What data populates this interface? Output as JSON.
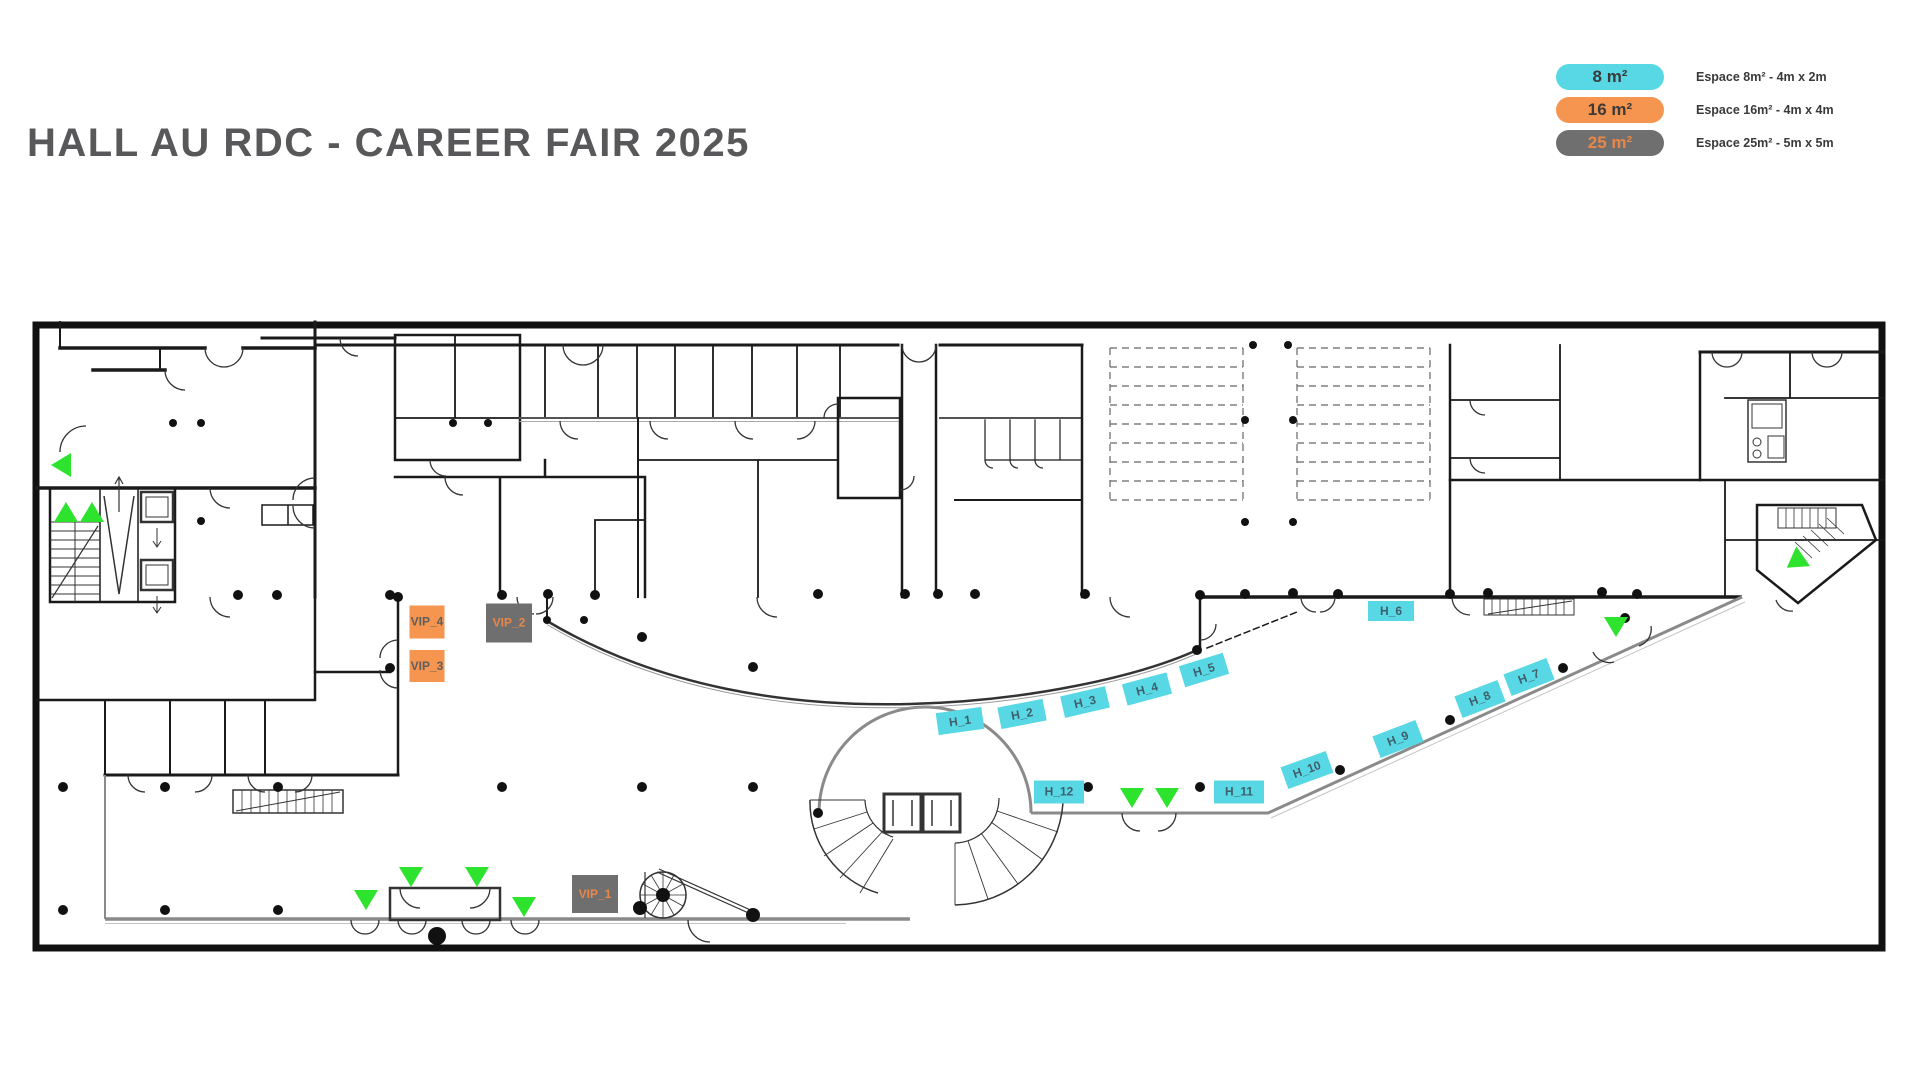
{
  "title": "HALL AU RDC - CAREER FAIR 2025",
  "legend": {
    "items": [
      {
        "label": "8 m²",
        "desc": "Espace 8m² - 4m x 2m",
        "color": "#58d8e4",
        "text_color": "#3a3a3a"
      },
      {
        "label": "16 m²",
        "desc": "Espace 16m² - 4m x 4m",
        "color": "#f6954f",
        "text_color": "#3a3a3a"
      },
      {
        "label": "25 m²",
        "desc": "Espace 25m² - 5m x 5m",
        "color": "#6f6f6f",
        "text_color": "#e8874a"
      }
    ]
  },
  "floorplan": {
    "colors": {
      "booth_8m2": "#58d8e4",
      "booth_16m2": "#f6954f",
      "booth_25m2": "#6f6f6f",
      "arrow_green": "#2ee32e",
      "wall": "#1a1a1a",
      "facade_gray": "#8a8a8a"
    },
    "booths": [
      {
        "id": "H_1",
        "label": "H_1",
        "size_m2": 8,
        "x": 960,
        "y": 721,
        "w": 46,
        "h": 22,
        "rot": -8
      },
      {
        "id": "H_2",
        "label": "H_2",
        "size_m2": 8,
        "x": 1022,
        "y": 714,
        "w": 46,
        "h": 22,
        "rot": -11
      },
      {
        "id": "H_3",
        "label": "H_3",
        "size_m2": 8,
        "x": 1085,
        "y": 702,
        "w": 46,
        "h": 22,
        "rot": -13
      },
      {
        "id": "H_4",
        "label": "H_4",
        "size_m2": 8,
        "x": 1147,
        "y": 689,
        "w": 46,
        "h": 22,
        "rot": -15
      },
      {
        "id": "H_5",
        "label": "H_5",
        "size_m2": 8,
        "x": 1204,
        "y": 670,
        "w": 46,
        "h": 22,
        "rot": -17
      },
      {
        "id": "H_6",
        "label": "H_6",
        "size_m2": 8,
        "x": 1391,
        "y": 611,
        "w": 46,
        "h": 20,
        "rot": 0
      },
      {
        "id": "H_7",
        "label": "H_7",
        "size_m2": 8,
        "x": 1529,
        "y": 677,
        "w": 46,
        "h": 23,
        "rot": -21
      },
      {
        "id": "H_8",
        "label": "H_8",
        "size_m2": 8,
        "x": 1480,
        "y": 699,
        "w": 46,
        "h": 23,
        "rot": -21
      },
      {
        "id": "H_9",
        "label": "H_9",
        "size_m2": 8,
        "x": 1398,
        "y": 739,
        "w": 46,
        "h": 23,
        "rot": -21
      },
      {
        "id": "H_10",
        "label": "H_10",
        "size_m2": 8,
        "x": 1307,
        "y": 770,
        "w": 48,
        "h": 23,
        "rot": -20
      },
      {
        "id": "H_11",
        "label": "H_11",
        "size_m2": 8,
        "x": 1239,
        "y": 792,
        "w": 50,
        "h": 23,
        "rot": 0
      },
      {
        "id": "H_12",
        "label": "H_12",
        "size_m2": 8,
        "x": 1059,
        "y": 792,
        "w": 50,
        "h": 23,
        "rot": 0
      },
      {
        "id": "VIP_1",
        "label": "VIP_1",
        "size_m2": 25,
        "x": 595,
        "y": 894,
        "w": 46,
        "h": 38,
        "rot": 0
      },
      {
        "id": "VIP_2",
        "label": "VIP_2",
        "size_m2": 25,
        "x": 509,
        "y": 623,
        "w": 46,
        "h": 39,
        "rot": 0
      },
      {
        "id": "VIP_3",
        "label": "VIP_3",
        "size_m2": 16,
        "x": 427,
        "y": 666,
        "w": 35,
        "h": 32,
        "rot": 0
      },
      {
        "id": "VIP_4",
        "label": "VIP_4",
        "size_m2": 16,
        "x": 427,
        "y": 622,
        "w": 35,
        "h": 33,
        "rot": 0
      }
    ],
    "arrows": [
      {
        "x": 61,
        "y": 465,
        "rot": -90
      },
      {
        "x": 66,
        "y": 512,
        "rot": 0
      },
      {
        "x": 92,
        "y": 512,
        "rot": 0
      },
      {
        "x": 366,
        "y": 900,
        "rot": 180
      },
      {
        "x": 411,
        "y": 877,
        "rot": 180
      },
      {
        "x": 477,
        "y": 877,
        "rot": 180
      },
      {
        "x": 524,
        "y": 907,
        "rot": 180
      },
      {
        "x": 1132,
        "y": 798,
        "rot": 180
      },
      {
        "x": 1167,
        "y": 798,
        "rot": 180
      },
      {
        "x": 1616,
        "y": 627,
        "rot": 180
      },
      {
        "x": 1795,
        "y": 562,
        "rot": 235
      }
    ]
  }
}
